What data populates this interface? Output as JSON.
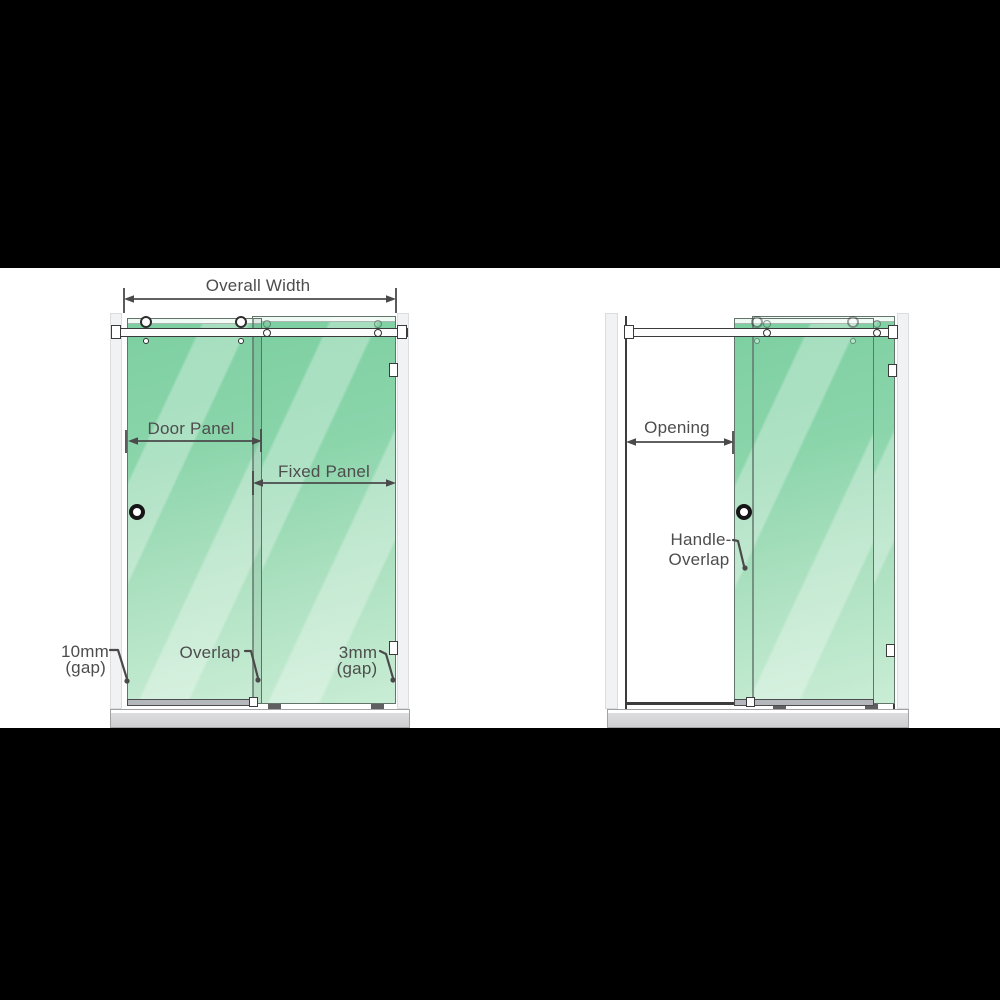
{
  "diagram": {
    "subject": "sliding-shower-door-dimension-diagram",
    "colors": {
      "background": "#ffffff",
      "letterbox": "#000000",
      "glass_top": "#7ccfa1",
      "glass_bottom": "#c9edd5",
      "annotation": "#4a4a4a",
      "tray": "#d2d2d4",
      "wall": "#f1f2f4"
    },
    "closed_view": {
      "overall_width": "Overall Width",
      "door_panel": "Door Panel",
      "fixed_panel": "Fixed Panel",
      "left_gap_value": "10mm",
      "left_gap_suffix": "(gap)",
      "overlap": "Overlap",
      "right_gap_value": "3mm",
      "right_gap_suffix": "(gap)"
    },
    "open_view": {
      "opening": "Opening",
      "handle_overlap_line1": "Handle-",
      "handle_overlap_line2": "Overlap"
    }
  }
}
